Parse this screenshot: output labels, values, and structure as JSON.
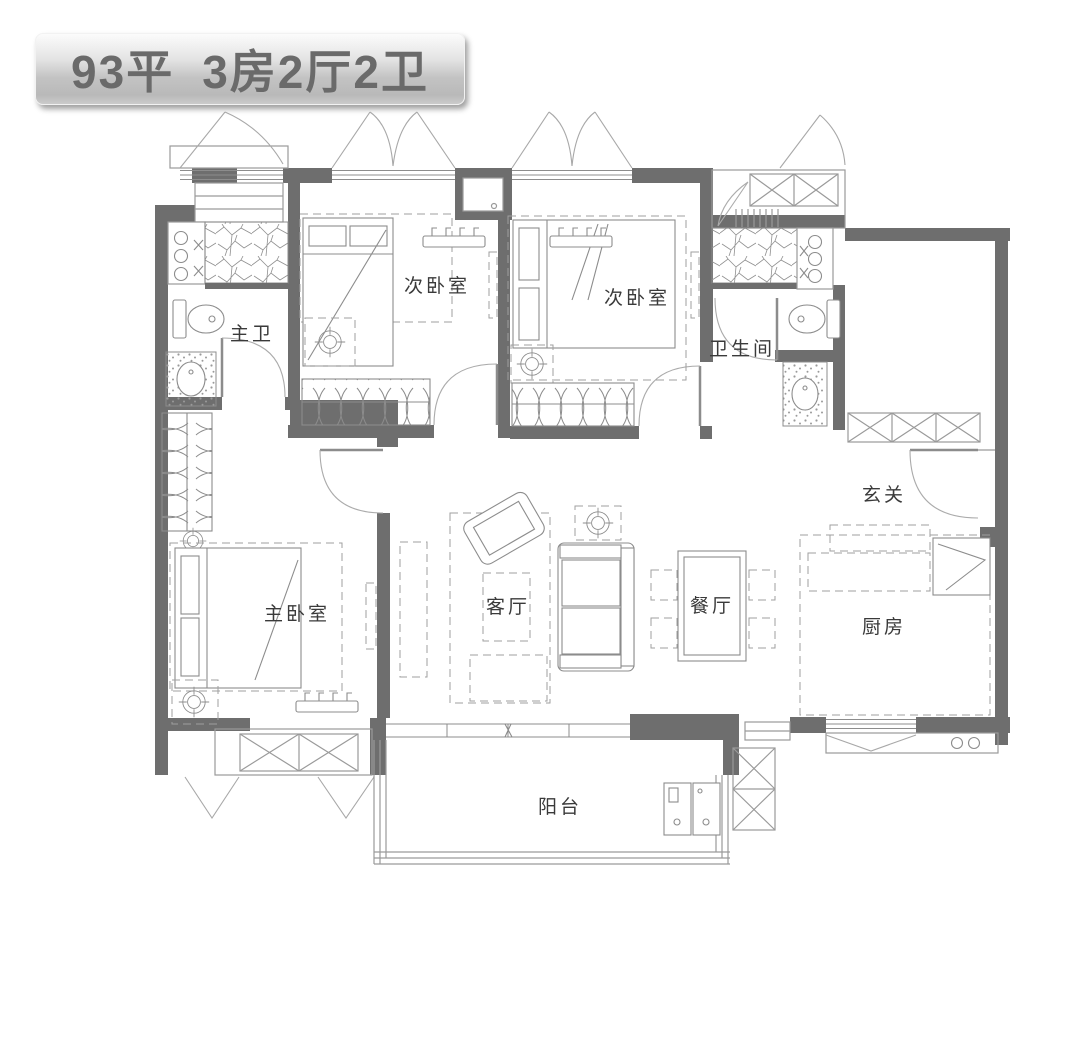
{
  "badge": {
    "area": "93平",
    "layout": "3房2厅2卫"
  },
  "floorplan": {
    "rooms": [
      {
        "id": "master-bath",
        "label": "主卫"
      },
      {
        "id": "bedroom-2",
        "label": "次卧室"
      },
      {
        "id": "bedroom-3",
        "label": "次卧室"
      },
      {
        "id": "bathroom",
        "label": "卫生间"
      },
      {
        "id": "foyer",
        "label": "玄关"
      },
      {
        "id": "master-bedroom",
        "label": "主卧室"
      },
      {
        "id": "living-room",
        "label": "客厅"
      },
      {
        "id": "dining-room",
        "label": "餐厅"
      },
      {
        "id": "kitchen",
        "label": "厨房"
      },
      {
        "id": "balcony",
        "label": "阳台"
      }
    ],
    "colors": {
      "wall": "#6e6e6e",
      "furniture_line": "#8c8c8c",
      "label_text": "#3a3a3a",
      "badge_text": "#6a6a6a",
      "background": "#ffffff"
    },
    "symbols": [
      "bed",
      "wardrobe",
      "toilet",
      "shower-area",
      "washbasin",
      "sofa",
      "armchair",
      "coffee-table",
      "dining-table",
      "fridge",
      "stove-burners",
      "washing-machine",
      "shoe-cabinet",
      "door-swing",
      "casement-window",
      "balcony-railing",
      "ac-platform",
      "ceiling-light"
    ]
  }
}
